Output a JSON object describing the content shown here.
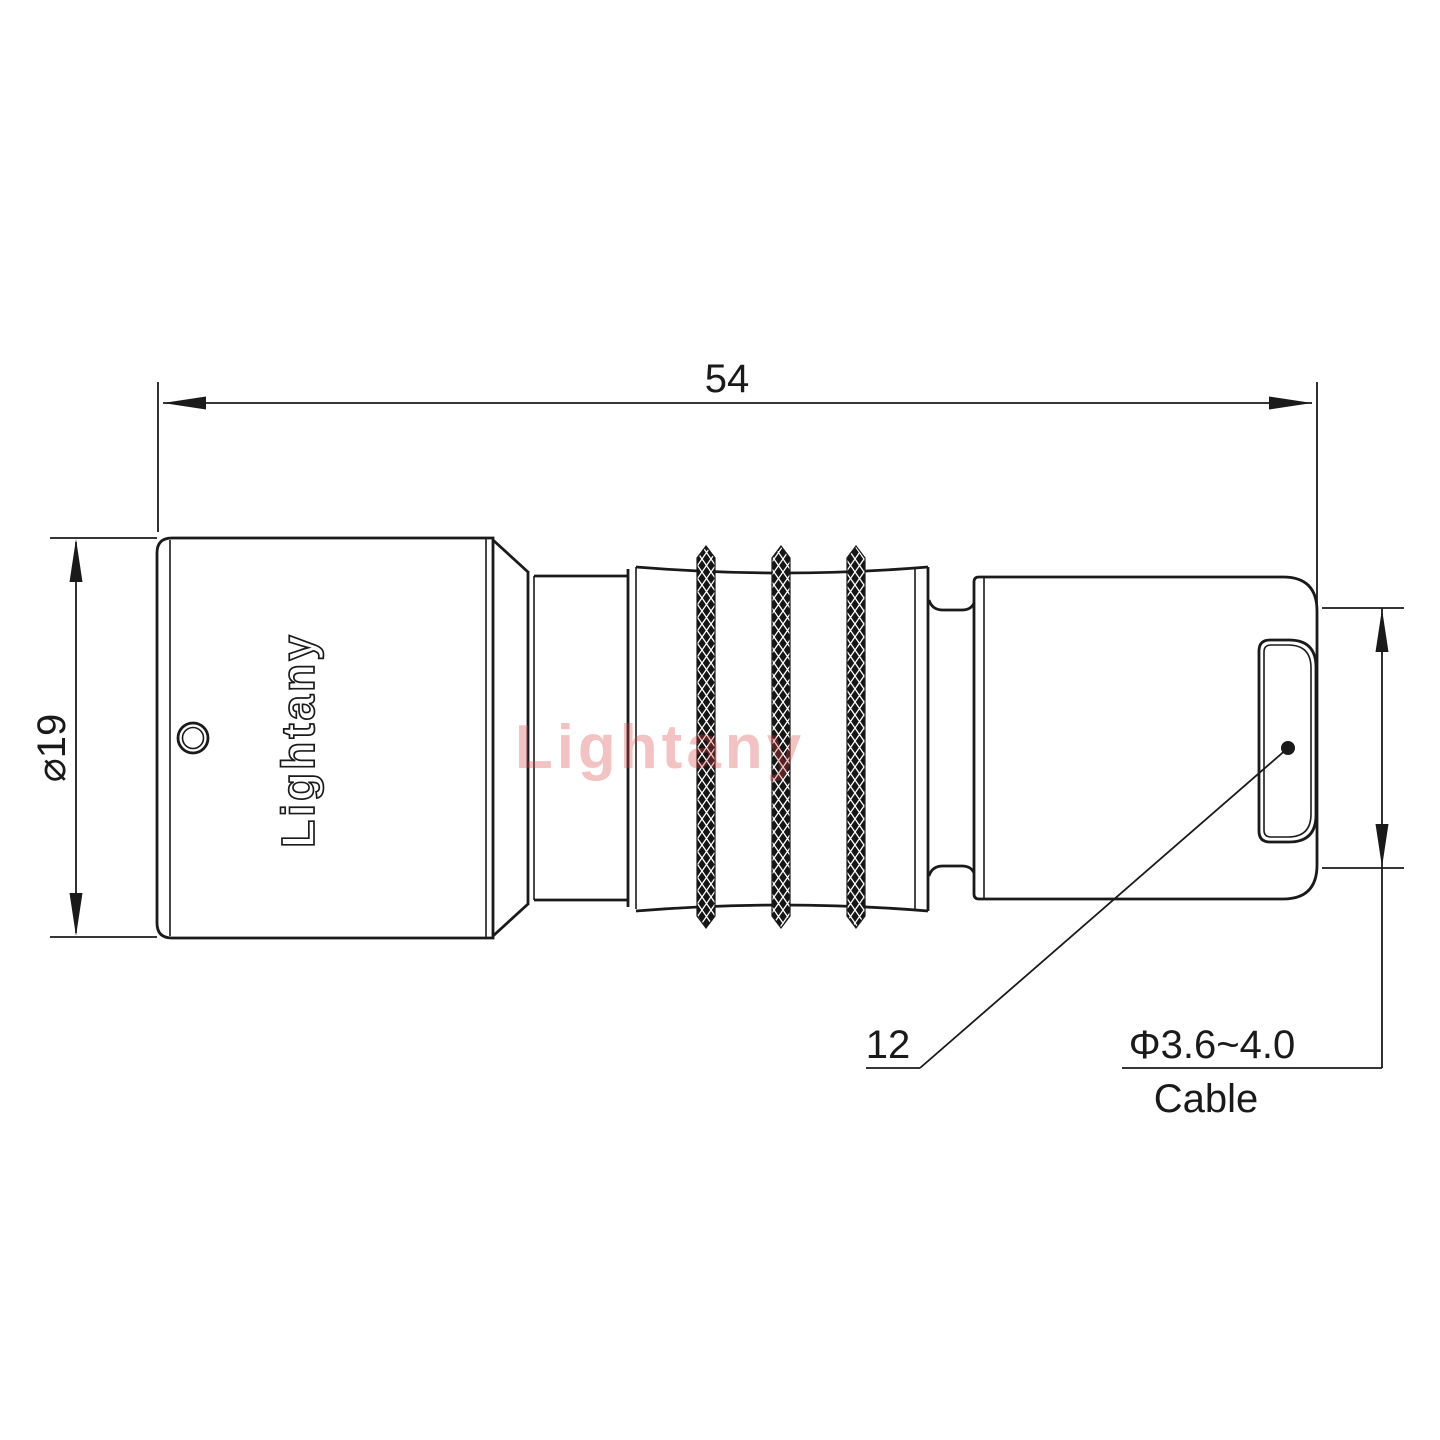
{
  "drawing": {
    "type": "technical-drawing",
    "subject": "push-pull circular connector plug, side view",
    "watermark": "Lightany",
    "body_logo": "Lightany",
    "dimensions": {
      "overall_length": "54",
      "body_diameter": "⌀19",
      "back_nut": "12",
      "cable_range": "Φ3.6~4.0",
      "cable_label": "Cable"
    },
    "colors": {
      "line": "#1a1a1a",
      "background": "#ffffff",
      "watermark": "rgba(219,64,64,0.32)"
    }
  }
}
